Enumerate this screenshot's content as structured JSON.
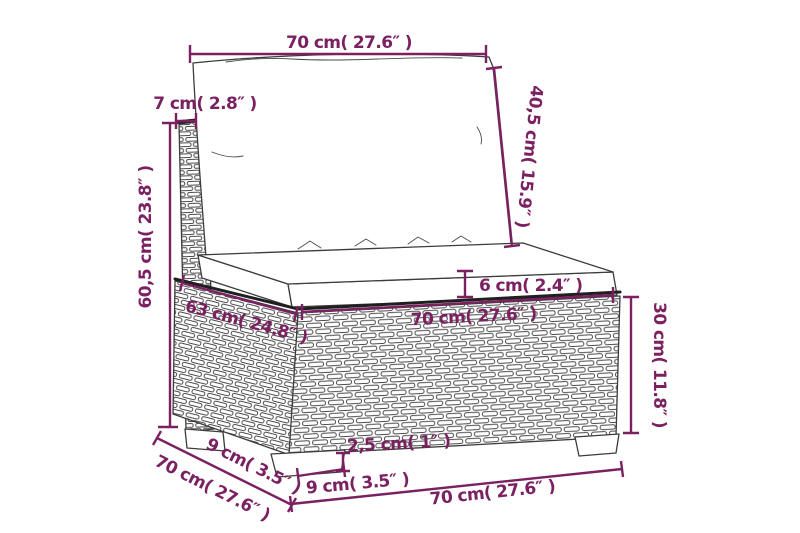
{
  "title": "Modular sofa section dimension diagram",
  "colors": {
    "accent": "#7b2161",
    "line_art": "#3c3c3c",
    "background": "#ffffff"
  },
  "dims": {
    "pillow_width": "70 cm( 27.6″ )",
    "pillow_height": "40,5 cm( 15.9″ )",
    "backrest_thickness": "7 cm( 2.8″ )",
    "overall_height": "60,5 cm( 23.8″ )",
    "seat_depth": "63 cm( 24.8″ )",
    "cushion_thickness": "6 cm( 2.4″ )",
    "seat_width": "70 cm( 27.6″ )",
    "base_height": "30 cm( 11.8″ )",
    "foot_depth": "9 cm( 3.5″ )",
    "overall_depth": "70 cm( 27.6″ )",
    "foot_height": "2,5 cm( 1″ )",
    "foot_width": "9 cm( 3.5″ )",
    "overall_width": "70 cm( 27.6″ )"
  }
}
